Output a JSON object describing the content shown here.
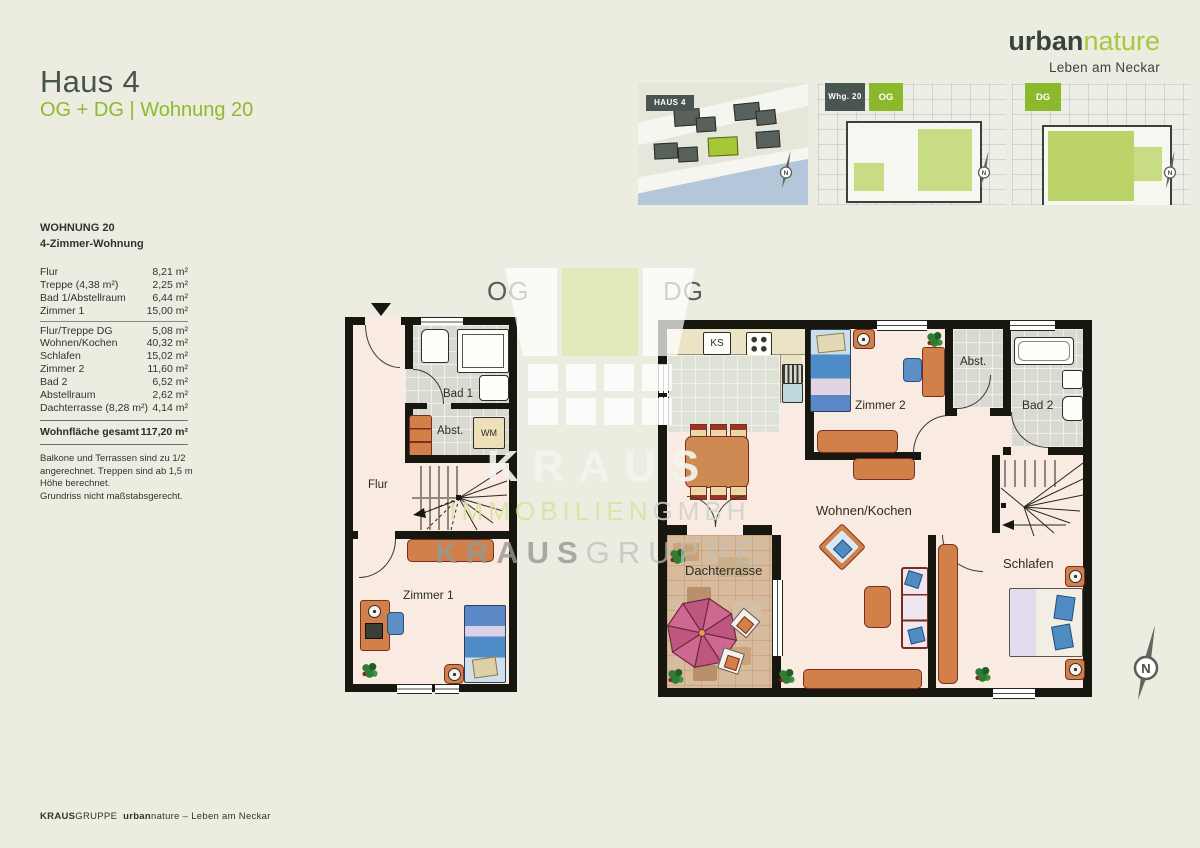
{
  "header": {
    "title": "Haus 4",
    "subtitle": "OG + DG | Wohnung 20"
  },
  "brand": {
    "urban": "urban",
    "nature": "nature",
    "tagline": "Leben am Neckar"
  },
  "thumbnails": {
    "site": {
      "badge": "HAUS 4"
    },
    "og": {
      "badge_unit": "Whg. 20",
      "badge_floor": "OG"
    },
    "dg": {
      "badge_floor": "DG"
    }
  },
  "compass": {
    "n": "N"
  },
  "sidebar": {
    "title": "WOHNUNG 20",
    "subtitle": "4-Zimmer-Wohnung",
    "rows": [
      {
        "label": "Flur",
        "value": "8,21 m²"
      },
      {
        "label": "Treppe (4,38 m²)",
        "value": "2,25 m²"
      },
      {
        "label": "Bad 1/Abstellraum",
        "value": "6,44 m²"
      },
      {
        "label": "Zimmer 1",
        "value": "15,00 m²"
      },
      {
        "label": "Flur/Treppe DG",
        "value": "5,08 m²"
      },
      {
        "label": "Wohnen/Kochen",
        "value": "40,32 m²"
      },
      {
        "label": "Schlafen",
        "value": "15,02 m²"
      },
      {
        "label": "Zimmer 2",
        "value": "11,60 m²"
      },
      {
        "label": "Bad 2",
        "value": "6,52 m²"
      },
      {
        "label": "Abstellraum",
        "value": "2,62 m²"
      },
      {
        "label": "Dachterrasse (8,28 m²)",
        "value": "4,14 m²"
      }
    ],
    "total_label": "Wohnfläche gesamt",
    "total_value": "117,20 m²",
    "note1": "Balkone und Terrassen sind zu 1/2 angerechnet. Treppen sind ab 1,5 m Höhe berechnet.",
    "note2": "Grundriss nicht maßstabsgerecht."
  },
  "plans": {
    "og": {
      "heading": "OG",
      "labels": {
        "bad1": "Bad 1",
        "abst": "Abst.",
        "wm": "WM",
        "flur": "Flur",
        "zimmer1": "Zimmer 1"
      }
    },
    "dg": {
      "heading": "DG",
      "labels": {
        "ks": "KS",
        "zimmer2": "Zimmer 2",
        "abst": "Abst.",
        "bad2": "Bad 2",
        "wohnen": "Wohnen/Kochen",
        "terrasse": "Dachterrasse",
        "schlafen": "Schlafen"
      }
    }
  },
  "watermark": {
    "kraus": "KRAUS",
    "immobilien": "IMMOBILIEN",
    "gmbh": "GMBH",
    "kraus2": "KRAUS",
    "gruppe": "GRUPPE"
  },
  "footer": {
    "kraus": "KRAUS",
    "gruppe": "GRUPPE",
    "urban": "urban",
    "nature": "nature",
    "tagline": " – Leben am Neckar"
  }
}
